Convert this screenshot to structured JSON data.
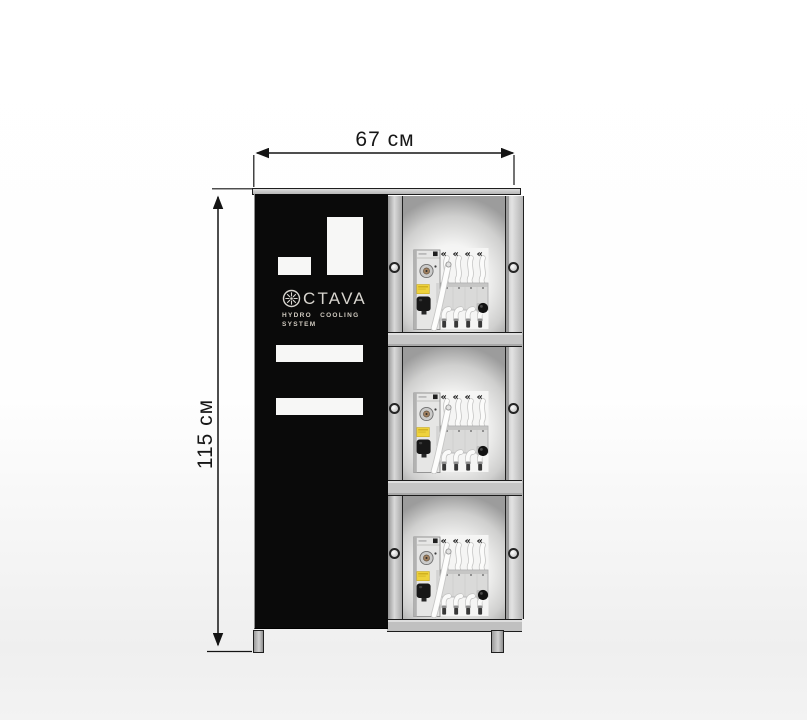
{
  "diagram": {
    "type": "product-dimension-diagram",
    "dimensions": {
      "width_label": "67 см",
      "height_label": "115 см"
    },
    "cabinet": {
      "brand": {
        "name": "OCTAVA",
        "wordmark_rest": "CTAVA",
        "logo_icon": "impeller-ring-icon",
        "tagline_line1": "HYDRO COOLING",
        "tagline_line2": "SYSTEM"
      },
      "compartment_count": 3,
      "nozzles_per_unit": 4,
      "colors": {
        "panel_black": "#0a0a0a",
        "frame_gray": "#c6c6c6",
        "outline": "#1c1c1c",
        "unit_label_yellow": "#eed23c",
        "logo_text": "#d8d5cf"
      }
    }
  }
}
